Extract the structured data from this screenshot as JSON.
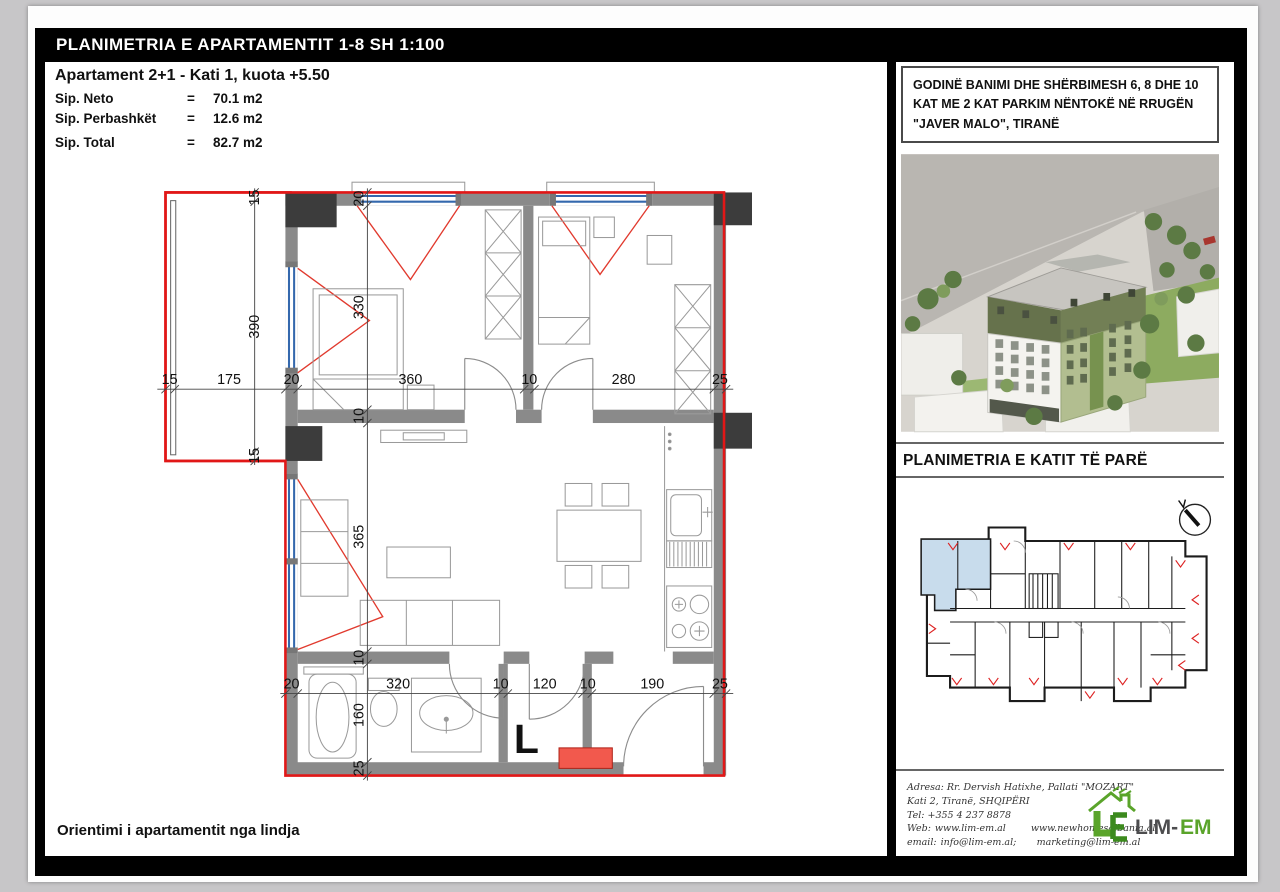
{
  "sheet": {
    "title": "PLANIMETRIA E APARTAMENTIT 1-8 SH 1:100",
    "orientation_note": "Orientimi i apartamentit nga lindja"
  },
  "apartment": {
    "heading": "Apartament 2+1 - Kati 1, kuota +5.50",
    "areas": [
      {
        "label": "Sip. Neto",
        "eq": "=",
        "value": "70.1 m2"
      },
      {
        "label": "Sip. Perbashkët",
        "eq": "=",
        "value": "12.6 m2"
      },
      {
        "label": "Sip. Total",
        "eq": "=",
        "value": "82.7 m2"
      }
    ]
  },
  "floor_plan": {
    "elevator_label": "L",
    "dims": {
      "h_top": [
        "15",
        "175",
        "20",
        "360",
        "10",
        "280",
        "25"
      ],
      "h_bottom": [
        "20",
        "320",
        "10",
        "120",
        "10",
        "190",
        "25"
      ],
      "v_left": [
        "15",
        "390",
        "15"
      ],
      "v_inner": [
        "20",
        "330",
        "10",
        "365",
        "10",
        "160",
        "25"
      ]
    }
  },
  "project": {
    "line1": "GODINË BANIMI DHE SHËRBIMESH 6, 8 DHE 10",
    "line2": "KAT ME 2 KAT PARKIM NËNTOKË NË RRUGËN",
    "line3": "\"JAVER MALO\", TIRANË"
  },
  "key_plan": {
    "title": "PLANIMETRIA E KATIT TË PARË"
  },
  "company": {
    "address_line1": "Adresa: Rr. Dervish Hatixhe, Pallati \"MOZART\"",
    "address_line2": "Kati 2, Tiranë, SHQIPËRI",
    "phone": "Tel: +355 4 237 8878",
    "web_label": "Web:",
    "web1": "www.lim-em.al",
    "web2": "www.newhomesalbania.al",
    "email_label": "email:",
    "email1": "info@lim-em.al;",
    "email2": "marketing@lim-em.al",
    "logo_dark": "LIM-",
    "logo_green": "EM"
  },
  "colors": {
    "boundary_red": "#e11717",
    "window_blue": "#3468ad",
    "wall_gray": "#8a8a8a",
    "column_dark": "#3c3c3c",
    "highlight_blue": "#c8dcec",
    "logo_green": "#5aa42a"
  }
}
